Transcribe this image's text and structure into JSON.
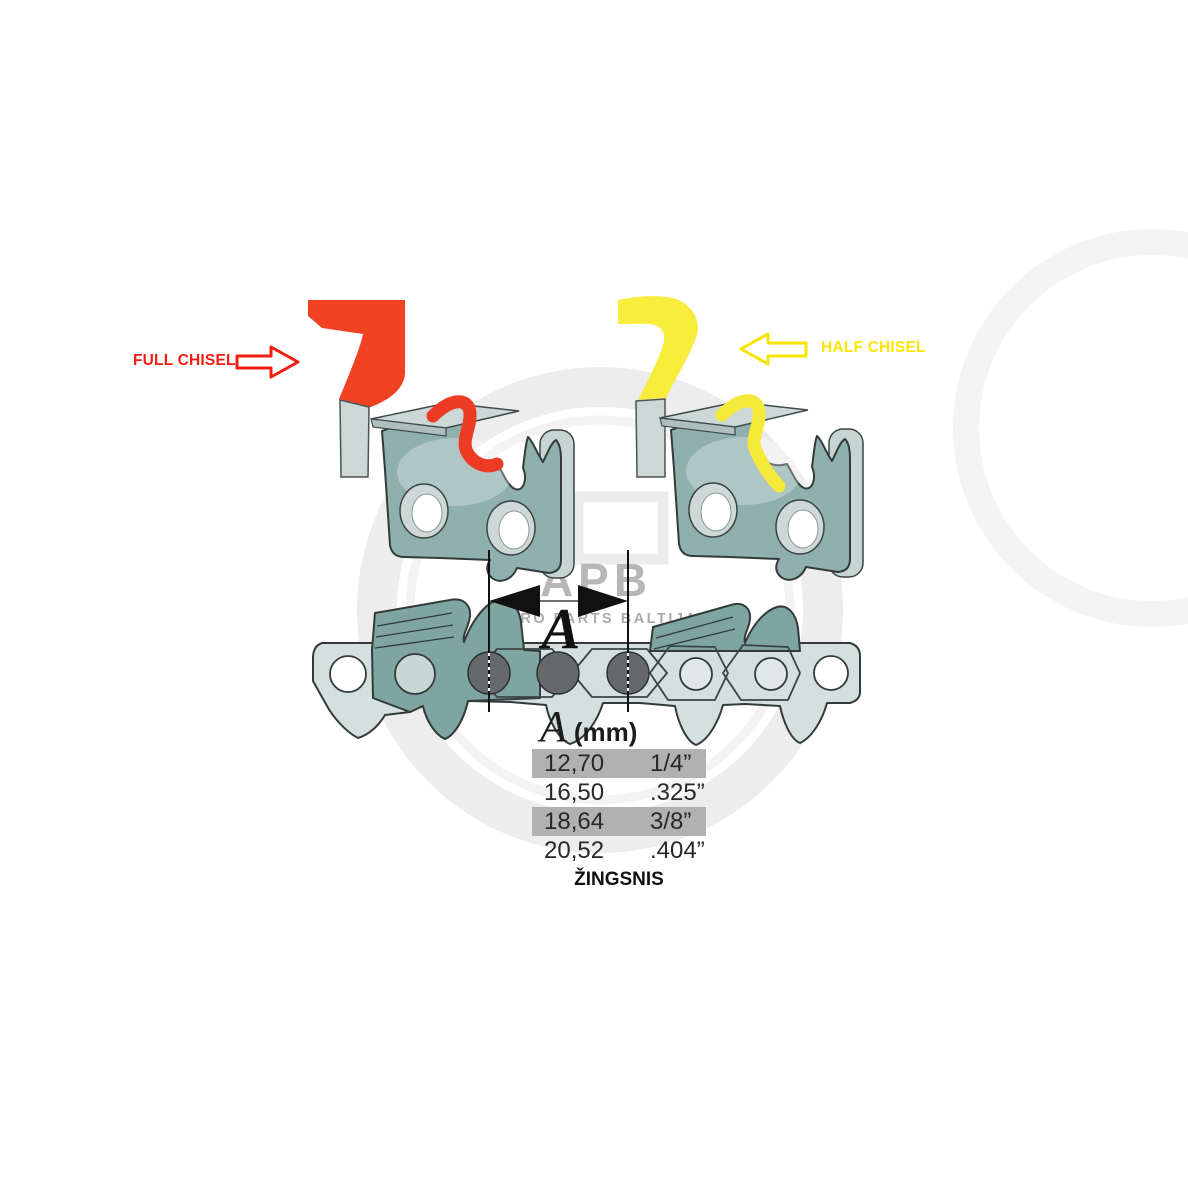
{
  "labels": {
    "full_chisel": "FULL CHISEL",
    "half_chisel": "HALF CHISEL"
  },
  "dimension": {
    "letter": "A"
  },
  "table": {
    "header_letter": "A",
    "header_unit": "(mm)",
    "rows": [
      {
        "mm": "12,70",
        "inch": "1/4”",
        "highlighted": true
      },
      {
        "mm": "16,50",
        "inch": ".325”",
        "highlighted": false
      },
      {
        "mm": "18,64",
        "inch": "3/8”",
        "highlighted": true
      },
      {
        "mm": "20,52",
        "inch": ".404”",
        "highlighted": false
      }
    ],
    "caption": "ŽINGSNIS"
  },
  "watermark": {
    "brand": "APB",
    "subtitle": "AGRO PARTS BALTIJA"
  },
  "colors": {
    "full_chisel_red": "#f04123",
    "full_chisel_text_red": "#f21d12",
    "half_chisel_yellow": "#f8ec3c",
    "half_chisel_text_yellow": "#ffe606",
    "link_body_teal": "#8fb0ad",
    "chain_cutter_teal": "#7fa5a2",
    "strap_teal": "#d3e0df",
    "rivet_gray": "#65696c",
    "table_highlight_gray": "#b1b1b1"
  }
}
